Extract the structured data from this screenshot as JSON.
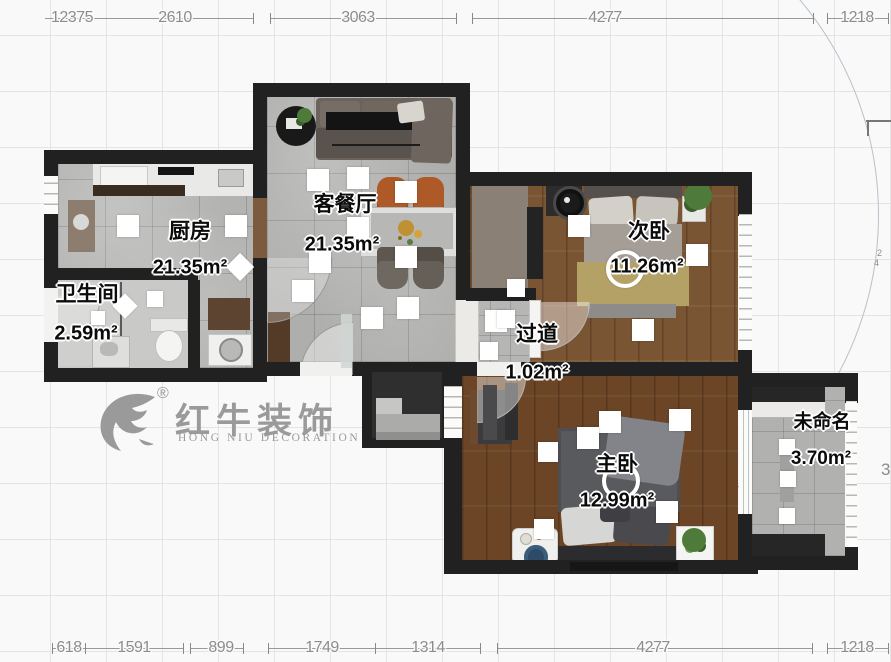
{
  "canvas": {
    "width": 891,
    "height": 662
  },
  "logo": {
    "cn": "红牛装饰",
    "en": "HONG NIU DECORATION",
    "registered": "®"
  },
  "rooms": {
    "kitchen": {
      "name": "厨房",
      "area": "21.35m²"
    },
    "bath": {
      "name": "卫生间",
      "area": "2.59m²"
    },
    "living": {
      "name": "客餐厅",
      "area": "21.35m²"
    },
    "bed2": {
      "name": "次卧",
      "area": "11.26m²"
    },
    "hall": {
      "name": "过道",
      "area": "1.02m²"
    },
    "master": {
      "name": "主卧",
      "area": "12.99m²"
    },
    "unnamed": {
      "name": "未命名",
      "area": "3.70m²"
    }
  },
  "dims": {
    "top": [
      "12375",
      "2610",
      "3063",
      "4277",
      "1218"
    ],
    "bottom": [
      "618",
      "1591",
      "899",
      "1749",
      "1314",
      "4277",
      "1218"
    ]
  },
  "edge_fragments": {
    "mid_a": "2",
    "mid_b": "4",
    "low": "3"
  },
  "colors": {
    "wall": "#212121",
    "tile": "#aeaeac",
    "wood_bed2": "#7a5534",
    "wood_master": "#6b4526",
    "chair_accent": "#ad5a28",
    "rug_navy": "#2d4a68",
    "plant": "#4e7a3a",
    "logo_gray": "#9a9a9a"
  }
}
